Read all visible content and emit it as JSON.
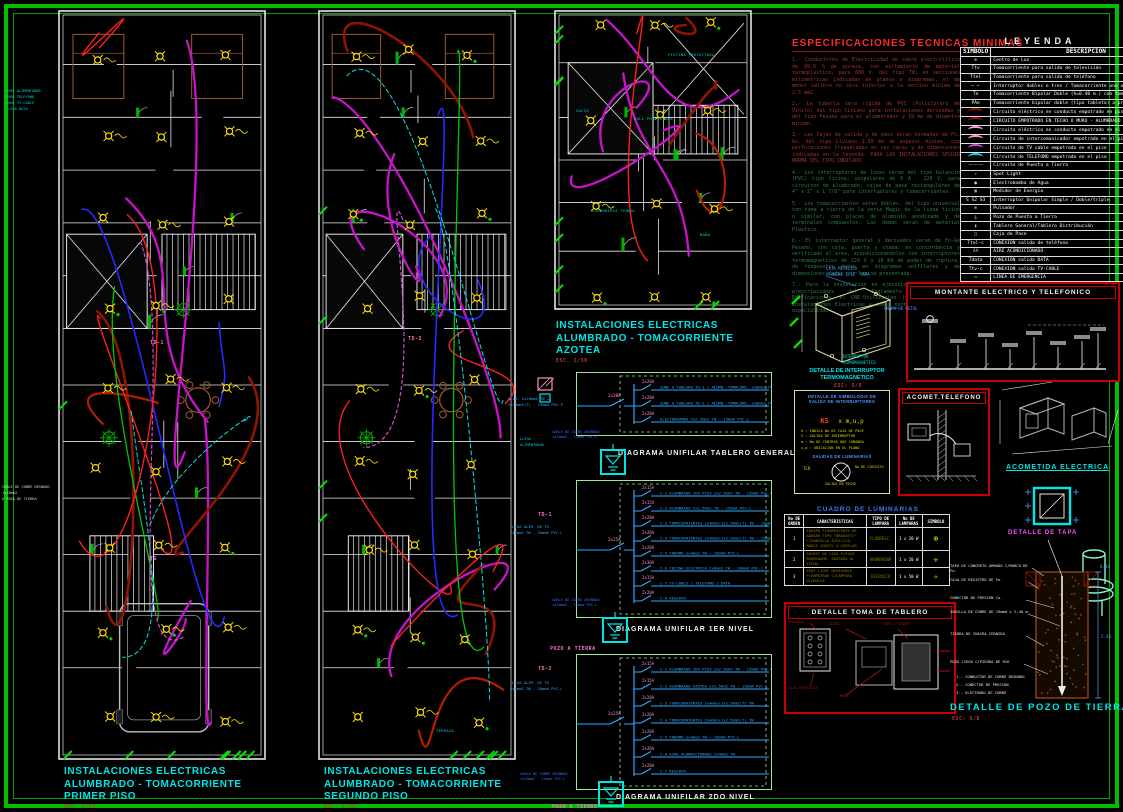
{
  "page": {
    "frame_color": "#00BE00",
    "background": "#000000",
    "accent_cyan": "#00E5E5",
    "accent_magenta": "#C814C8",
    "accent_red": "#C80000",
    "accent_yellow": "#FFE100"
  },
  "plans": [
    {
      "title_lines": [
        "INSTALACIONES ELECTRICAS",
        "ALUMBRADO - TOMACORRIENTE",
        "PRIMER PISO"
      ],
      "scale": "ESC. 1/50",
      "tags": [
        "TG",
        "TD-1"
      ]
    },
    {
      "title_lines": [
        "INSTALACIONES ELECTRICAS",
        "ALUMBRADO - TOMACORRIENTE",
        "SEGUNDO PISO"
      ],
      "scale": "ESC. 1/50",
      "tags": [
        "TD-2"
      ],
      "room_labels": [
        "TERRAZA"
      ]
    },
    {
      "title_lines": [
        "INSTALACIONES ELECTRICAS",
        "ALUMBRADO - TOMACORRIENTE",
        "AZOTEA"
      ],
      "scale": "ESC. 1/50",
      "room_labels": [
        "PISCINA PROYECTADA",
        "HALL PROYECTADA",
        "VACIO",
        "LAVANDERIA TENDAL",
        "BAÑO"
      ]
    }
  ],
  "margin_notes": {
    "left_top": [
      "SUBE ALIMENTADOR",
      "SUBE TELEFONO",
      "SUBE TV-CABLE",
      "LLEGA DATA"
    ],
    "left_mid": [
      "CABLE DE COBRE DESNUDO",
      "1x10mm2",
      "A POZO DE TIERRA"
    ],
    "plan2_right": [
      "LLEGA",
      "ALIMENTADOR"
    ]
  },
  "specs": {
    "title": "ESPECIFICACIONES  TECNICAS  MINIMAS",
    "items_red": [
      "1.- Conductores de Electricidad de cobre electrolitico de 99.9 % de pureza, con aislamiento de material termoplastico, para 600 V. del tipo TW, en secciones milimetricas indicadas en planos y diagramas, el de menor calibre no sera inferior a la seccion minima de 2.5 mm2.",
      "2.- La tuberia sera rigida de PVC (Policloruro de Vinilo) del tipo liviano para instalaciones derivadas y del tipo Pesado para el alimentador y 19 mm de diametro minimo.",
      "3.- Las Cajas de salida y de paso seran normadas de Fo. Go. del tipo Liviano 1.59 mm de espesor minimo, con perforaciones troqueladas en sus caras y de dimensiones indicadas en la leyenda. PARA LAS INSTALACIONES SEGUIR NORMA DEL TIPO INDICADO."
    ],
    "items_green": [
      "4.- Los interruptores de luces seran del tipo balancin (PVC) tipo ticino; unipolares de 6 A - 220 V. para circuitos de alumbrado; cajas de pase rectangulares de 4\" x 2\" x 1 7/8\" para interruptores y tomacorrientes.",
      "5.- Los tomacorrientes seran dobles, del tipo universal con toma a tierra de la serie Magic de la linea ticino o similar, con placas de aluminio anodizado y de terminales compuestos. Las demas seran de material Plastico.",
      "6.- El interruptor general y derivados seran de Fo-Go Pesado, con caja, puerta y chapa; en concordancia y verificado al area, acondicionandolos con interruptores termomagneticos de 220 V y 10 KA de poder de ruptura, de respuestas dadas en diagramas unifilares y de dimensiones dadas por lamina presentada.",
      "7.- Para la instalacion en ejecucion se regiran las prescripciones del Reglamento Nacional de Edificaciones, el CNE-Utilizacion (y V. A.) de las Instalaciones Electricas y demas normas vigentes en la especialidad."
    ]
  },
  "legend": {
    "title": "LEYENDA",
    "headers": {
      "symbol": "SIMBOLO",
      "desc": "DESCRIPCION"
    },
    "rows": [
      {
        "sym": "⊕",
        "color": "#FFE100",
        "desc": "Centro de Luz"
      },
      {
        "sym": "Ttv",
        "color": "#FFFFFF",
        "desc": "Tomacorriente para salida de televisión"
      },
      {
        "sym": "Ttel",
        "color": "#FFFFFF",
        "desc": "Tomacorriente para salida de teléfono"
      },
      {
        "sym": "⌐ ⌐",
        "color": "#FFFFFF",
        "desc": "Interruptor dobles o tres / Tomacorriente uno o dos"
      },
      {
        "sym": "T⊘",
        "color": "#FFFFFF",
        "desc": "Tomacorriente Bipolar Doble (h=0.40 m.) con toma de Puesta a Tierra"
      },
      {
        "sym": "PA⊘",
        "color": "#FFFFFF",
        "desc": "Tomacorriente bipolar doble (tipo tableta) a prueba de agua"
      },
      {
        "arc": "#8C1400",
        "desc": "Circuito eléctrico en conducto empotrado en piso - alimentador"
      },
      {
        "arc": "#8C1400",
        "desc": "CIRCUITO EMPOTRADO EN TECHO O MURO - ALUMBRADO Y OTROS"
      },
      {
        "arc": "#FF9ED2",
        "desc": "Circuito eléctrico en conducto empotrado en el piso o muro"
      },
      {
        "arc": "#FF9ED2",
        "desc": "Circuito de intercomunicador empotrado en el piso"
      },
      {
        "arc": "#D24BD2",
        "desc": "Circuito de TV cable empotrado en el piso"
      },
      {
        "arc": "#00E5E5",
        "desc": "Circuito de TELEFONO empotrado en el piso"
      },
      {
        "sym": "−·−·−",
        "color": "#FFFFFF",
        "desc": "Circuito de Puesta a Tierra"
      },
      {
        "sym": "✧",
        "color": "#FFFFFF",
        "desc": "Spot Light"
      },
      {
        "sym": "◉",
        "color": "#FFFFFF",
        "desc": "Electrobomba de Agua"
      },
      {
        "sym": "▣",
        "color": "#FF9ED2",
        "desc": "Medidor de Energía"
      },
      {
        "sym": "S S2 S3",
        "color": "#FFFFFF",
        "desc": "Interruptor Unipolar Simple / Doble/triple"
      },
      {
        "sym": "⊙",
        "color": "#FFFFFF",
        "desc": "Pulsador"
      },
      {
        "sym": "⏚",
        "color": "#FFFFFF",
        "desc": "Pozo de Puesta a Tierra"
      },
      {
        "sym": "▮",
        "color": "#FF9ED2",
        "desc": "Tablero General/Tablero Distribución"
      },
      {
        "sym": "▢",
        "color": "#FFFFFF",
        "desc": "Caja de Pase"
      },
      {
        "sym": "Ttel-c",
        "color": "#FFFFFF",
        "desc": "CONEXION salida de teléfono"
      },
      {
        "sym": "AA",
        "color": "#FF9ED2",
        "desc": "AIRE ACONDICIONADO"
      },
      {
        "sym": "Tdata",
        "color": "#FFFFFF",
        "desc": "CONEXION salida DATA"
      },
      {
        "sym": "Ttv-c",
        "color": "#FFFFFF",
        "desc": "CONEXION salida TV-CABLE"
      },
      {
        "sym": "▭",
        "color": "#FFE100",
        "desc": "LINEA DE EMERGENCIA"
      }
    ]
  },
  "unifilar": {
    "boards": [
      {
        "name": "TG",
        "main_breaker": "2x30A",
        "feeder": [
          "ALIM. 2x10mm2 TW +",
          "1x10mm2(T) - 25mm⌀ PVC-P"
        ],
        "label": "DIAGRAMA UNIFILAR  TABLERO GENERAL",
        "circuits": [
          {
            "breaker": "2x20A",
            "desc": "SUBE A TABLERO TD-1 / ALUMB.-TOMACORR. 2x6mm2 TW-20mm⌀ PVC-L"
          },
          {
            "breaker": "2x20A",
            "desc": "SUBE A TABLERO TD-2 / ALUMB.-TOMACORR. 2x6mm2 TW-20mm⌀ PVC-L"
          },
          {
            "breaker": "2x20A",
            "desc": "ELECTROBOMBA 2x2.5mm2 TW - 15mm⌀ PVC-L"
          }
        ],
        "ground": [
          "CABLE DE COBRE DESNUDO",
          "1x10mm2 - 15mm⌀ PVC-L"
        ],
        "ground_label": "POZO A TIERRA"
      },
      {
        "name": "TD-1",
        "main_breaker": "2x25A",
        "feeder": [
          "LLEGA ALIM. DE TG",
          "2x6mm2 TW - 20mm⌀ PVC-L"
        ],
        "label": "DIAGRAMA UNIFILAR   1ER NIVEL",
        "circuits": [
          {
            "breaker": "2x15A",
            "desc": "C-1 ALUMBRADO 1ER PISO 2x2.5mm2 TW - 15mm⌀ PVC-L"
          },
          {
            "breaker": "2x15A",
            "desc": "C-2 ALUMBRADO 2x2.5mm2 TW - 15mm⌀ PVC-L"
          },
          {
            "breaker": "2x20A",
            "desc": "C-3 TOMACORRIENTES 2x4mm2+1x2.5mm2(T) TW - 15mm⌀ PVC-L"
          },
          {
            "breaker": "2x20A",
            "desc": "C-4 TOMACORRIENTES 2x4mm2+1x2.5mm2(T) TW - 15mm⌀ PVC-L"
          },
          {
            "breaker": "2x20A",
            "desc": "C-5 THERMA 2x4mm2 TW - 15mm⌀ PVC-L"
          },
          {
            "breaker": "2x30A",
            "desc": "C-6 COCINA ELECTRICA 2x6mm2 TW - 20mm⌀ PVC-L"
          },
          {
            "breaker": "2x15A",
            "desc": "C-7 TV-CABLE / TELEFONO / DATA"
          },
          {
            "breaker": "2x20A",
            "desc": "C-8 RESERVA"
          }
        ],
        "ground": [
          "CABLE DE COBRE DESNUDO",
          "1x10mm2 - 15mm⌀ PVC-L"
        ],
        "ground_label": "POZO A TIERRA"
      },
      {
        "name": "TD-2",
        "main_breaker": "2x25A",
        "feeder": [
          "LLEGA ALIM. DE TG",
          "2x6mm2 TW - 20mm⌀ PVC-L"
        ],
        "label": "DIAGRAMA UNIFILAR   2DO NIVEL",
        "circuits": [
          {
            "breaker": "2x15A",
            "desc": "C-1 ALUMBRADO 2DO PISO 2x2.5mm2 TW - 15mm⌀ PVC-L"
          },
          {
            "breaker": "2x15A",
            "desc": "C-2 ALUMBRADO AZOTEA 2x2.5mm2 TW - 15mm⌀ PVC-L"
          },
          {
            "breaker": "2x20A",
            "desc": "C-3 TOMACORRIENTES 2x4mm2+1x2.5mm2(T) TW"
          },
          {
            "breaker": "2x20A",
            "desc": "C-4 TOMACORRIENTES 2x4mm2+1x2.5mm2(T) TW"
          },
          {
            "breaker": "2x20A",
            "desc": "C-5 THERMA 2x4mm2 TW - 15mm⌀ PVC-L"
          },
          {
            "breaker": "2x20A",
            "desc": "C-6 AIRE ACONDICIONADO 2x4mm2 TW"
          },
          {
            "breaker": "2x20A",
            "desc": "C-7 RESERVA"
          }
        ],
        "ground": [
          "CABLE DE COBRE DESNUDO",
          "1x10mm2 - 15mm⌀ PVC-L"
        ],
        "ground_label": "POZO A TIERRA"
      }
    ]
  },
  "details": {
    "caja": {
      "label_top": [
        "CAJA METALICA",
        "PLANCHA 1/16\" TAPA"
      ],
      "label_side": "CHAPA DE METAL",
      "label_bottom": [
        "INTERRUPTOR",
        "TERMOMAGNETICO"
      ],
      "title": [
        "DETALLE DE INTERRUPTOR",
        "TERMOMAGNETICO"
      ],
      "scale": "ESC: S/E"
    },
    "montante": {
      "title": "MONTANTE ELECTRICO Y TELEFONICO"
    },
    "simbologia": {
      "title": [
        "DETALLE DE SIMBOLOGIA DE",
        "SALIDA DE INTERRUPTORES"
      ],
      "formula_left": "KS",
      "formula_right": "x m,u,p",
      "items": [
        "K : INDICA No DE CAJA DE PASE",
        "S : SALIDA DE INTERRUPTOR",
        "m : No DE CENTROS QUE COMANDA",
        "u,p : UBICACION EN EL PLANO"
      ],
      "subtitle": "SALIDAS DE LUMINARIAS",
      "label_left": "TLR",
      "label_right": "No DE CIRCUITO",
      "label_bottom": "SALIDA EN TECHO"
    },
    "acometida_telefono": {
      "title": "ACOMET.TELEFONO"
    },
    "acometida_electrica": {
      "title": "ACOMETIDA ELECTRICA"
    },
    "cuadro": {
      "title": "CUADRO DE LUMINARIAS",
      "headers": [
        "No DE ORDEN",
        "CARACTERISTICAS",
        "TIPO DE LAMPARA",
        "No DE LAMPARAS",
        "SIMBOLO"
      ],
      "rows": [
        {
          "n": "1",
          "desc": "EQUIPO FLUORESCENTE DE ADOSAR TIPO \"BRAQUETE\" C/PANTALLA ACRILICA, MARCA JOSFEL O SIMILAR",
          "tipo": "FLUORESC.",
          "lamp": "1 x 20 W",
          "sym": "⊕"
        },
        {
          "n": "2",
          "desc": "SOCKET DE LOZA P/FOCO AHORRADOR, ADOSADO AL TECHO",
          "tipo": "AHORRADOR",
          "lamp": "1 x 20 W",
          "sym": "✛"
        },
        {
          "n": "3",
          "desc": "SPOT LIGHT DIRIGIBLE P/EMPOTRAR C/LAMPARA DICROICA",
          "tipo": "DICROICO",
          "lamp": "1 x 50 W",
          "sym": "✧"
        }
      ]
    },
    "toma_tablero": {
      "title": "DETALLE TOMA DE TABLERO",
      "labels": [
        "CAJA METALICA",
        "DADO",
        "TAPA C/CHAPA",
        "MURO",
        "TABLERO"
      ]
    },
    "pozo": {
      "tapa_label": "DETALLE DE TAPA",
      "title": "DETALLE DE POZO   DE TIERRA",
      "scale": "ESC: S/E",
      "annotations": [
        "TAPA DE CONCRETO ARMADO C/MARCO DE Fo.",
        "CAJA DE REGISTRO DE Fo.",
        "CONECTOR DE PRESION Cu.",
        "VARILLA DE COBRE DE 19mm⌀ x 2.40 m.",
        "TIERRA DE CHACRA CERNIDA",
        "POZO CIEGO C/PIEDRA DE RIO"
      ],
      "notes": [
        "1.- CONDUCTOR DE COBRE DESNUDO",
        "2.- CONECTOR DE PRESION",
        "3.- ELECTRODO DE COBRE"
      ],
      "dims": [
        "0.40",
        "2.40"
      ]
    }
  }
}
